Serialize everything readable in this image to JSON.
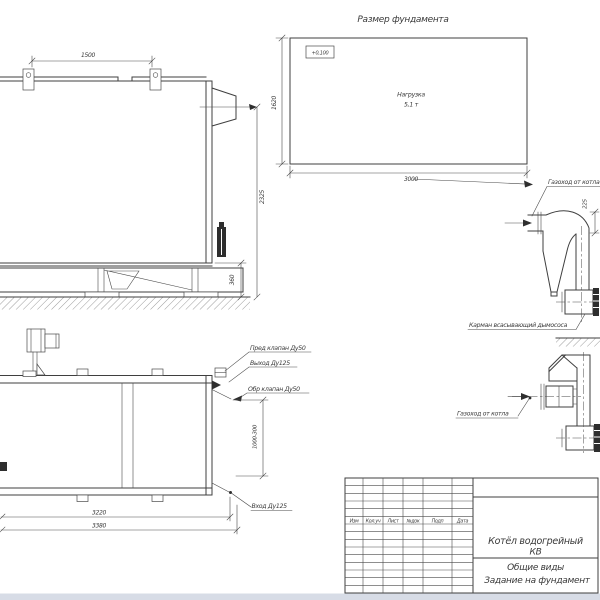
{
  "drawing": {
    "foundation_plan": {
      "title": "Размер фундамента",
      "level_mark": "+0,100",
      "load_label": "Нагрузка",
      "load_value": "5,1 т",
      "width_dim": "3000",
      "depth_dim": "1620"
    },
    "boiler_side_view": {
      "lug_spacing_dim": "1500",
      "height_dim": "2325",
      "frame_height_dim": "360"
    },
    "boiler_plan_view": {
      "safety_valve_label": "Пред клапан Ду50",
      "outlet_label": "Выход Ду125",
      "check_valve_label": "Обр клапан Ду50",
      "inlet_label": "Вход Ду125",
      "nozzle_offset_dim": "1000-300",
      "body_length_dim": "3220",
      "overall_length_dim": "3380"
    },
    "flue_duct_side": {
      "duct_label": "Газоход от котла",
      "offset_dim": "225",
      "pocket_label": "Карман всасывающий дымососа"
    },
    "flue_duct_front": {
      "duct_label": "Газоход от котла"
    },
    "title_block": {
      "columns": [
        "Изм",
        "Кол.уч",
        "Лист",
        "№док",
        "Подп",
        "Дата"
      ],
      "product_line1": "Котёл водогрейный",
      "product_line2": "КВ",
      "doc_line1": "Общие виды",
      "doc_line2": "Задание на фундамент"
    },
    "colors": {
      "line": "#3f3f3f",
      "paper": "#ffffff",
      "window_strip": "#d7dce6"
    }
  }
}
